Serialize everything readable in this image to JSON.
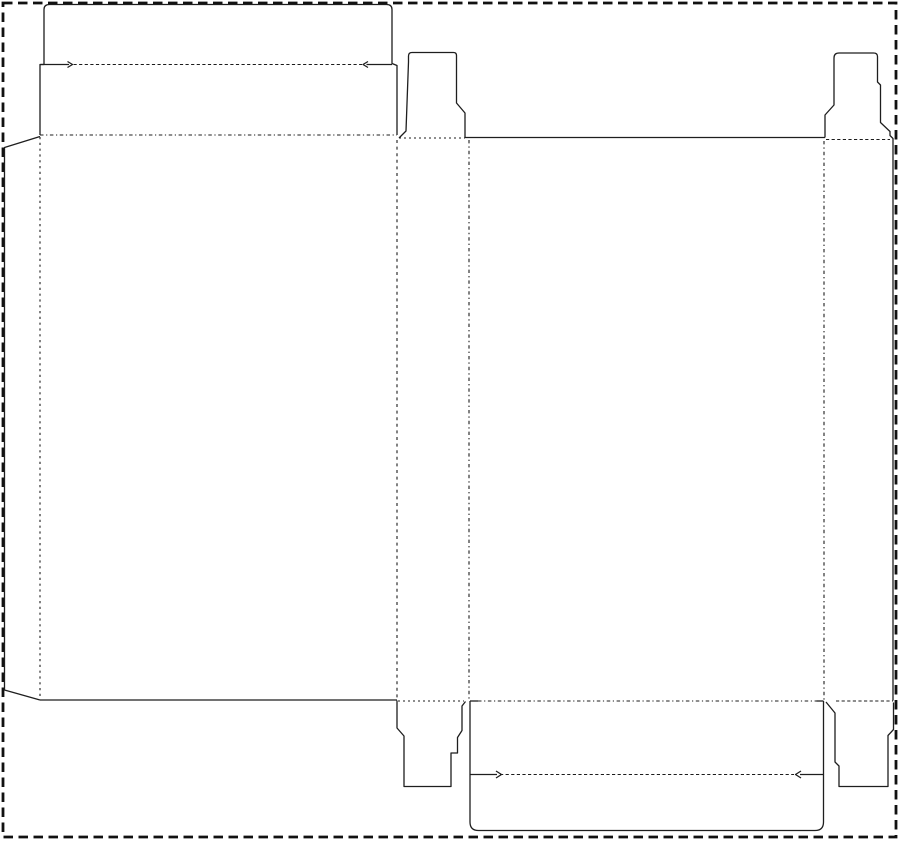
{
  "canvas": {
    "width": 900,
    "height": 841,
    "background": "#ffffff"
  },
  "colors": {
    "cut_line": "#1e1e1e",
    "fold_line": "#1c1c1c",
    "border_line": "#111111"
  },
  "stroke_widths": {
    "cut": 1.3,
    "fold": 1.1,
    "border": 2.8
  },
  "border": {
    "x": 3,
    "y": 3,
    "width": 893,
    "height": 834,
    "dash": "9.5,5.5"
  },
  "dieline": {
    "cuts": [
      {
        "name": "glue-flap-edge",
        "d": "M 40,136.5 L 4.5,147.5 L 4.5,690 L 40,700"
      },
      {
        "name": "top-lid-and-tuck-outline",
        "d": "M 40,135 L 40,64.5 L 44,64.5 L 44,9.5 Q 44,4.5 49.5,4.5 L 386.5,4.5 Q 392,4.5 392,9.5 L 392,63.5 L 397,65.5 L 397,135"
      },
      {
        "name": "lid-crease-left-shoulder",
        "d": "M 40.5,64.5 L 69,64.5 M 67.5,61.5 L 72.5,64.5 L 67.5,67.5"
      },
      {
        "name": "lid-crease-right-shoulder",
        "d": "M 392,64.5 L 366.5,64.5 M 368,61.5 L 363,64.5 L 368,67.5"
      },
      {
        "name": "top-dust-flap-side1",
        "d": "M 399,138 L 406,131 L 408.5,62 L 408.5,56 Q 408.5,52.5 412,52.5 L 453.5,52.5 Q 456.5,52.5 456.5,55.5 L 456.5,103 L 465,113 L 465,137.5"
      },
      {
        "name": "back-panel-top-cut",
        "d": "M 465,137.5 L 825,137.5"
      },
      {
        "name": "top-dust-flap-side2-and-right-edge",
        "d": "M 825,137.5 L 825,115 L 834,105 L 834,58 Q 834,53 839,53 L 873.5,53 Q 877.5,53 877.5,56.5 L 877.5,82 L 880.5,85 L 880.5,122.5 L 890,131.5 L 890,135.5 L 893,138.5 L 893,700.5"
      },
      {
        "name": "front-panel-bottom-cut",
        "d": "M 40,700 L 397,700"
      },
      {
        "name": "bottom-dust-flap-side1",
        "d": "M 397,700.5 L 397,728 L 404,736 L 404,786.5 L 451,786.5 L 451,753 L 457.5,753 L 457.5,737.5 L 462,730.5 L 462,706 L 465.5,701.5"
      },
      {
        "name": "bottom-lid-and-tuck-outline",
        "d": "M 470,701 L 470,822 Q 470,830.5 478.5,830.5 L 815,830.5 Q 823.5,830.5 823.5,822 L 823.5,701"
      },
      {
        "name": "bottom-fold-left-shoulder",
        "d": "M 470,701 L 478,701"
      },
      {
        "name": "bottom-fold-right-shoulder",
        "d": "M 816.5,701 L 823.5,701"
      },
      {
        "name": "bottom-crease-left-shoulder",
        "d": "M 470,774.5 L 497,774.5 M 496,771 L 501.5,774.5 L 496,778"
      },
      {
        "name": "bottom-crease-right-shoulder",
        "d": "M 823.5,774.5 L 800,774.5 M 801,771 L 795.5,774.5 L 801,778"
      },
      {
        "name": "bottom-dust-flap-side2",
        "d": "M 826,702 L 835,713 L 835,762 L 839,766 L 839,786.5 L 888,786.5 L 888,735.5 L 893.5,729.5 L 893.5,702.5"
      }
    ],
    "folds": [
      {
        "name": "glue-flap-fold",
        "d": "M 40,137 L 40,699.5",
        "dash": "2.2,3.6"
      },
      {
        "name": "front-lid-fold",
        "d": "M 40,135 L 397,135",
        "dash": "3.5,2.6,1.2,2.6"
      },
      {
        "name": "lid-tuck-crease-top",
        "d": "M 73.5,64.5 L 362,64.5",
        "dash": "3.2,2.4"
      },
      {
        "name": "dust-flap-crease-top-side1",
        "d": "M 399,138 L 465,138",
        "dash": "2,3"
      },
      {
        "name": "front-side1-fold",
        "d": "M 397,140 L 397,700",
        "dash": "3,3.6"
      },
      {
        "name": "side1-back-fold",
        "d": "M 469,140 L 469,700",
        "dash": "3.4,3,1.4,3"
      },
      {
        "name": "dust-flap-crease-top-side2",
        "d": "M 826,139.5 L 890,139.5",
        "dash": "3.2,2.4"
      },
      {
        "name": "back-side2-fold",
        "d": "M 824,141 L 824,700.5",
        "dash": "3.4,3,1.4,3"
      },
      {
        "name": "dust-flap-crease-bottom-side1",
        "d": "M 398,701 L 464,701",
        "dash": "2,3"
      },
      {
        "name": "back-lid-fold",
        "d": "M 478,701 L 816.5,701",
        "dash": "3.5,2.6,1.2,2.6"
      },
      {
        "name": "lid-tuck-crease-bottom",
        "d": "M 500,774.5 L 794,774.5",
        "dash": "3.2,2.4"
      },
      {
        "name": "dust-flap-crease-bottom-side2",
        "d": "M 836,701 L 893,701",
        "dash": "3.2,2.4"
      }
    ]
  }
}
